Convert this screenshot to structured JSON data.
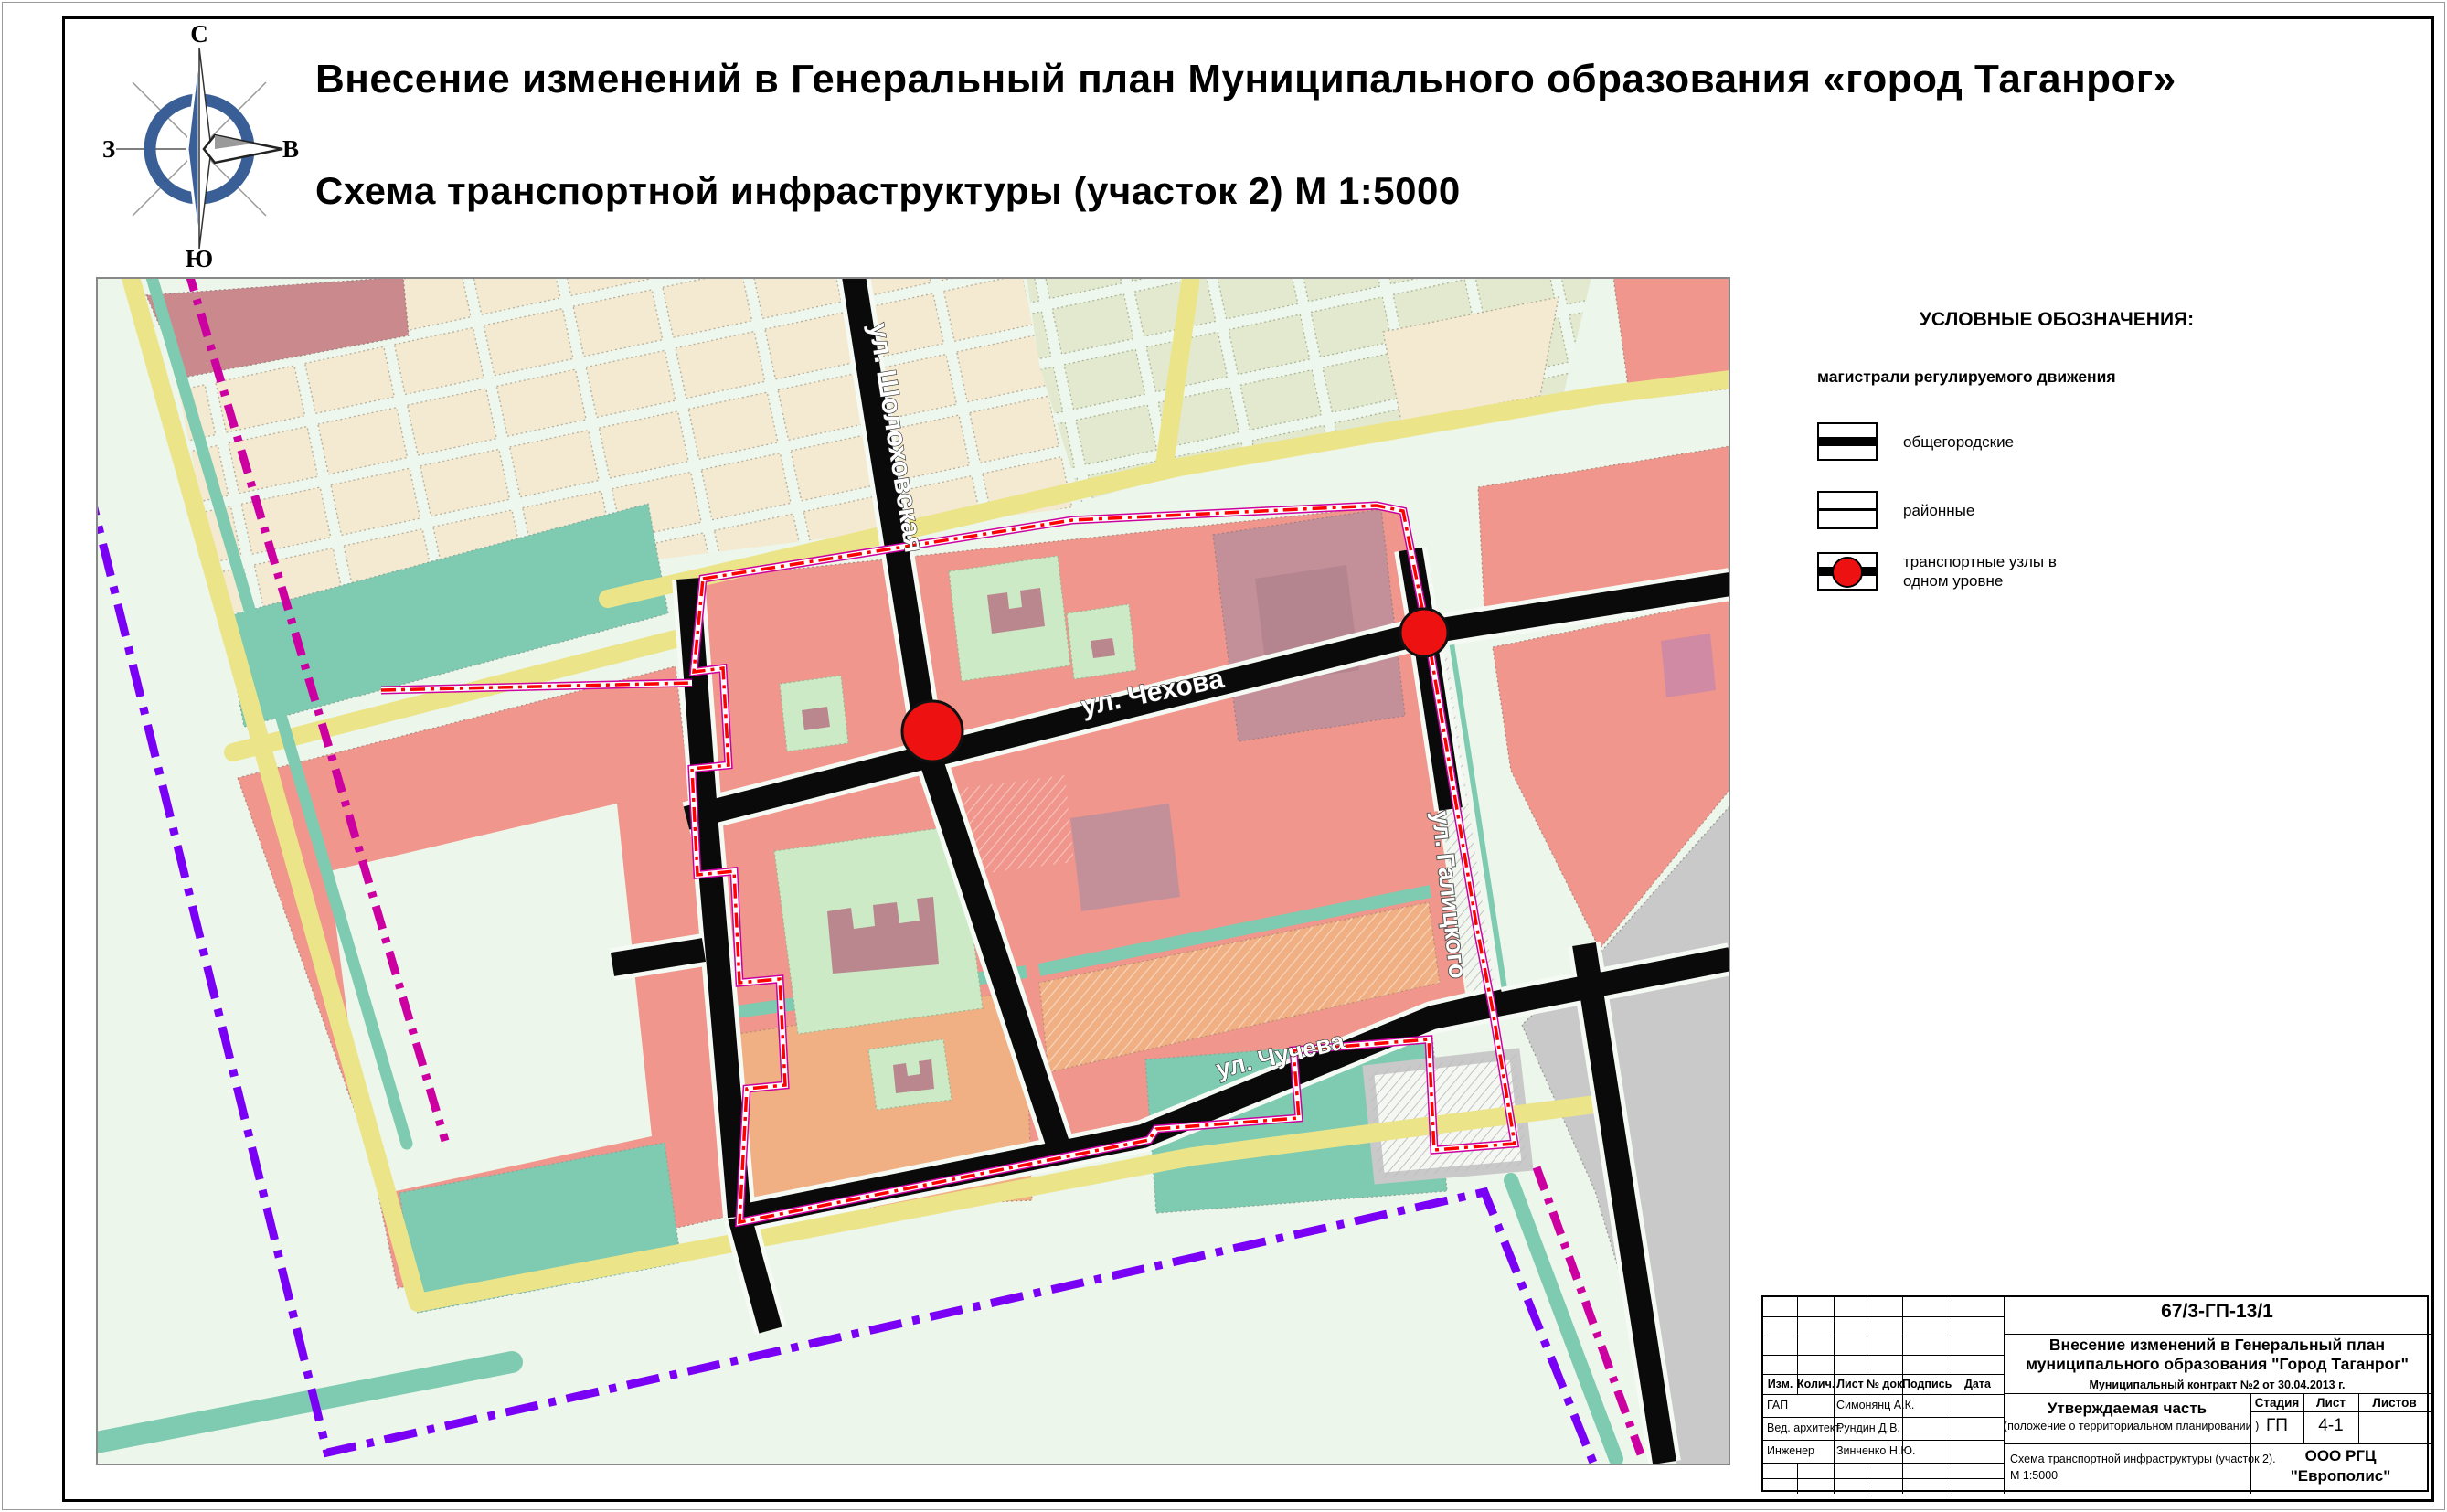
{
  "header": {
    "title": "Внесение изменений в Генеральный план Муниципального образования «город Таганрог»",
    "subtitle": "Схема транспортной инфраструктуры (участок 2)  М 1:5000"
  },
  "compass": {
    "north": "С",
    "south": "Ю",
    "west": "З",
    "east": "В"
  },
  "legend": {
    "heading": "УСЛОВНЫЕ ОБОЗНАЧЕНИЯ:",
    "subheading": "магистрали регулируемого движения",
    "items": [
      {
        "symbol": "citywide-road",
        "label": "общегородские"
      },
      {
        "symbol": "district-road",
        "label": "районные"
      },
      {
        "symbol": "transport-node",
        "label": "транспортные узлы  в",
        "label2": "одном уровне"
      }
    ]
  },
  "map": {
    "streets": [
      {
        "label": "ул. Шолоховская"
      },
      {
        "label": "ул. Чехова"
      },
      {
        "label": "ул. Чучева"
      },
      {
        "label": "ул. Галицкого"
      }
    ],
    "transport_nodes_count": "2"
  },
  "titleblock": {
    "doc_number": "67/3-ГП-13/1",
    "project_line1": "Внесение изменений в Генеральный  план",
    "project_line2": "муниципального образования  \"Город Таганрог\"",
    "contract": "Муниципальный контракт  №2 от 30.04.2013 г.",
    "cols": [
      "Изм.",
      "Колич.",
      "Лист",
      "№ док.",
      "Подпись",
      "Дата"
    ],
    "roles": [
      {
        "role": "ГАП",
        "name": "Симонянц А.К."
      },
      {
        "role": "Вед. архитект.",
        "name": "Рундин Д.В."
      },
      {
        "role": "Инженер",
        "name": "Зинченко Н.Ю."
      }
    ],
    "section_title_line1": "Утверждаемая часть",
    "section_title_line2": "(положение о территориальном планировании )",
    "stage_label": "Стадия",
    "sheet_label": "Лист",
    "sheets_label": "Листов",
    "stage": "ГП",
    "sheet": "4-1",
    "sheets": "",
    "drawing_title_line1": "Схема транспортной инфраструктуры (участок 2).",
    "drawing_title_line2": "М 1:5000",
    "company_line1": "ООО РГЦ",
    "company_line2": "\"Европолис\""
  },
  "palette": {
    "bg": "#edf6ea",
    "salmon": "#f0968c",
    "beige": "#f4e9d1",
    "palegreen": "#e2e9cf",
    "mauve": "#c9898d",
    "blockmauve": "#c3909a",
    "mauvedark": "#b4858f",
    "orange": "#f0b083",
    "teal": "#7ecbb2",
    "yellow": "#ece489",
    "green": "#cdeac6",
    "building": "#b9878d",
    "gray": "#c9c9c9",
    "red": "#ee1111",
    "boundary": "#ff0000",
    "magenta": "#cc00a0",
    "purple": "#7a00f5",
    "pink": "#d08aa4",
    "blue": "#3a5f96",
    "road": "#0a0a0a"
  }
}
